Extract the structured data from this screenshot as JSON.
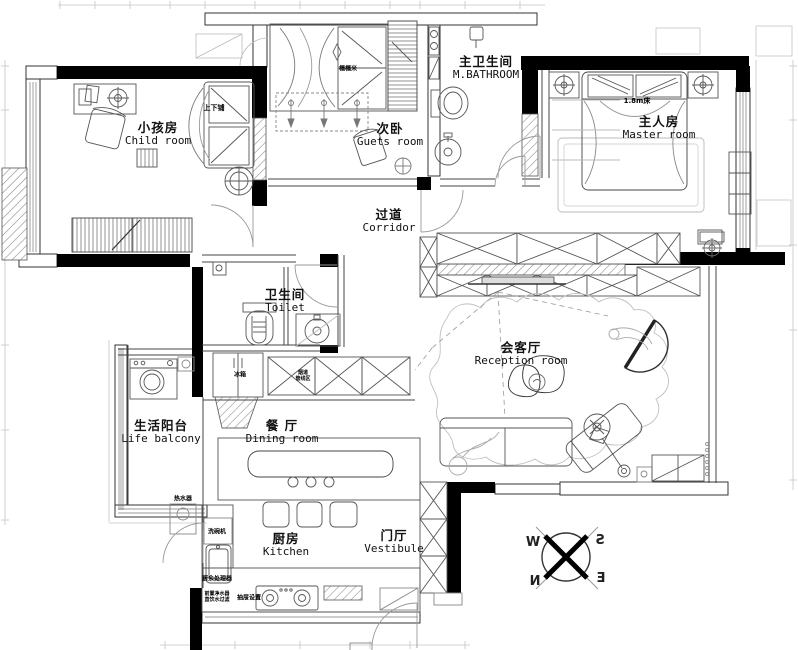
{
  "rooms": {
    "child": {
      "zh": "小孩房",
      "en": "Child room"
    },
    "guest": {
      "zh": "次卧",
      "en": "Guets room"
    },
    "mbath": {
      "zh": "主卫生间",
      "en": "M.BATHROOM"
    },
    "master": {
      "zh": "主人房",
      "en": "Master room"
    },
    "corridor": {
      "zh": "过道",
      "en": "Corridor"
    },
    "toilet": {
      "zh": "卫生间",
      "en": "Toilet"
    },
    "reception": {
      "zh": "会客厅",
      "en": "Reception room"
    },
    "balcony": {
      "zh": "生活阳台",
      "en": "Life balcony"
    },
    "dining": {
      "zh": "餐 厅",
      "en": "Dining room"
    },
    "kitchen": {
      "zh": "厨房",
      "en": "Kitchen"
    },
    "vestibule": {
      "zh": "门厅",
      "en": "Vestibule"
    }
  },
  "furniture_labels": {
    "bunk_bed": "上下铺",
    "tatami": "榻榻米",
    "master_bed": "1.8m床",
    "fridge": "冰箱",
    "duct_l1": "烟道",
    "duct_l2": "管线区",
    "water_heater": "热水器",
    "dishwasher": "洗碗机",
    "waste_processor": "厨余处理器",
    "filter_l1": "前置净水器",
    "filter_l2": "直饮水过滤",
    "drawers": "抽屉设置"
  },
  "compass": {
    "n": "N",
    "s": "S",
    "e": "E",
    "w": "W"
  },
  "colors": {
    "wall": "#000000",
    "line": "#444444",
    "light": "#999999",
    "faint": "#cccccc"
  }
}
